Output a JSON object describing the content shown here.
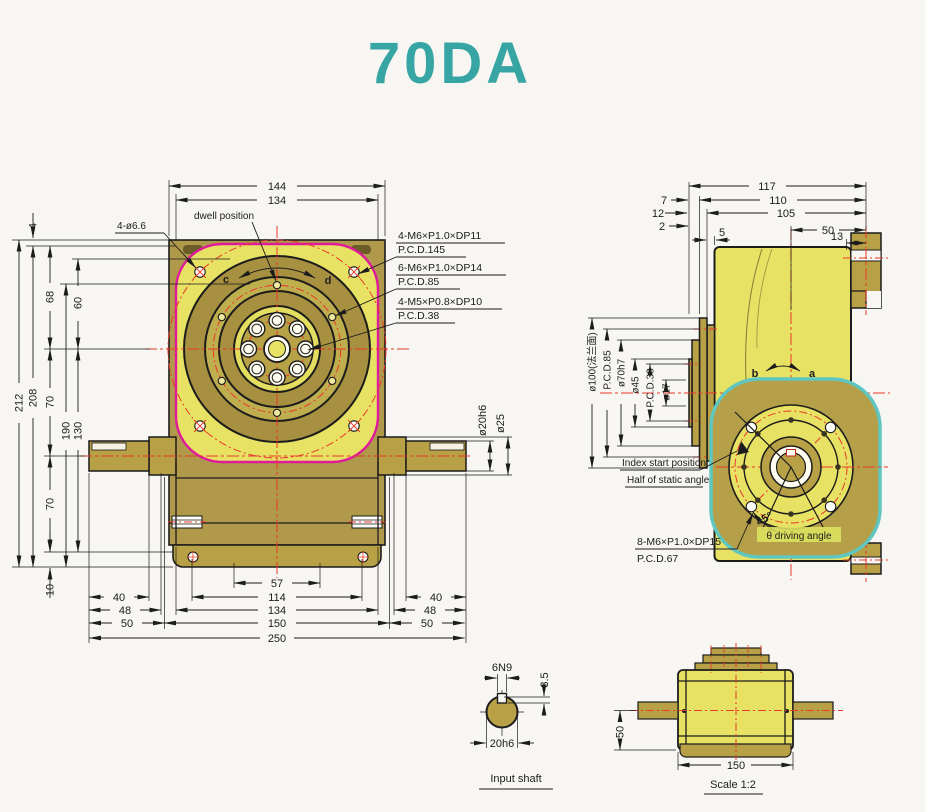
{
  "title": "70DA",
  "colors": {
    "accent_teal": "#36a5a3",
    "magenta_outline": "#df1a9b",
    "teal_outline": "#5fc6c0",
    "centerline_red": "#e8392a",
    "face_yellow": "#e7e263",
    "ring_olive": "#a79040",
    "body_tan": "#b7a045",
    "ink": "#1c1c1c",
    "paper": "#f7f6f3"
  },
  "front": {
    "dwell_label": "dwell position",
    "corner_hole_label": "4-ø6.6",
    "rotate_left": "c",
    "rotate_right": "d",
    "specs": [
      {
        "l1": "4-M6×P1.0×DP11",
        "l2": "P.C.D.145"
      },
      {
        "l1": "6-M6×P1.0×DP14",
        "l2": "P.C.D.85"
      },
      {
        "l1": "4-M5×P0.8×DP10",
        "l2": "P.C.D.38"
      }
    ],
    "dim_top_outer": "144",
    "dim_top_inner": "134",
    "dim_lip": "4",
    "dims_left": {
      "d212": "212",
      "d208": "208",
      "d68": "68",
      "d60": "60",
      "d70a": "70",
      "d190": "190",
      "d130": "130",
      "d70b": "70",
      "d10": "10"
    },
    "dims_bottom": {
      "d57": "57",
      "d114": "114",
      "d134": "134",
      "d150": "150",
      "d250": "250",
      "left40": "40",
      "left48": "48",
      "left50": "50",
      "right40": "40",
      "right48": "48",
      "right50": "50"
    },
    "shaft_dims": {
      "d20": "ø20h6",
      "d25": "ø25"
    }
  },
  "side": {
    "dims_top": {
      "d117": "117",
      "d110": "110",
      "d105": "105",
      "d7": "7",
      "d12": "12",
      "d2": "2",
      "d5": "5",
      "d50": "50",
      "d13": "13"
    },
    "dims_left": {
      "d100": "ø100(法兰面)",
      "pcd85": "P.C.D.85",
      "d70h7": "ø70h7",
      "d45": "ø45",
      "pcd38": "P.C.D.38",
      "d17": "ø17"
    },
    "rotate_left": "b",
    "rotate_right": "a",
    "index_start": "Index start position",
    "half_static": "Half of static angle",
    "spec_l1": "8-M6×P1.0×DP15",
    "spec_l2": "P.C.D.67",
    "angle45": "45°",
    "driving_angle": "θ driving angle"
  },
  "input_shaft": {
    "key_width": "6N9",
    "key_depth": "3.5",
    "shaft_dia": "20h6",
    "caption": "Input shaft"
  },
  "scale_view": {
    "d50": "50",
    "d150": "150",
    "caption": "Scale 1:2"
  }
}
